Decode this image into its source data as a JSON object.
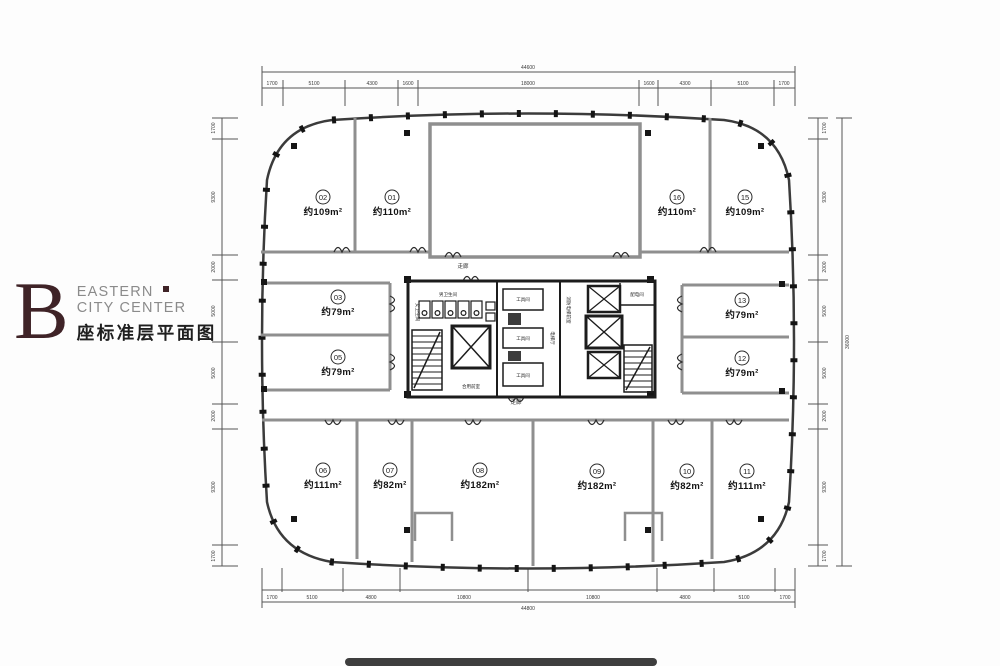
{
  "logo": {
    "letter": "B",
    "name_line1": "EASTERN",
    "name_line2": "CITY CENTER",
    "subtitle": "座标准层平面图",
    "brand_color": "#3f2327",
    "text_color": "#8b8b8b"
  },
  "plan": {
    "units": [
      {
        "num": "01",
        "area": "约110m²"
      },
      {
        "num": "02",
        "area": "约109m²"
      },
      {
        "num": "03",
        "area": "约79m²"
      },
      {
        "num": "05",
        "area": "约79m²"
      },
      {
        "num": "06",
        "area": "约111m²"
      },
      {
        "num": "07",
        "area": "约82m²"
      },
      {
        "num": "08",
        "area": "约182m²"
      },
      {
        "num": "09",
        "area": "约182m²"
      },
      {
        "num": "10",
        "area": "约82m²"
      },
      {
        "num": "11",
        "area": "约111m²"
      },
      {
        "num": "12",
        "area": "约79m²"
      },
      {
        "num": "13",
        "area": "约79m²"
      },
      {
        "num": "15",
        "area": "约109m²"
      },
      {
        "num": "16",
        "area": "约110m²"
      }
    ],
    "core": {
      "corridor_top": "走廊",
      "corridor_bottom": "走廊",
      "mens_wc": "男卫生间",
      "womens_wc": "女卫生间",
      "shared_lobby": "合用前室",
      "elevator_hall": "电梯厅",
      "fire_elevator_lobby": "消防电梯前室",
      "tool_room": "工具间",
      "power_room": "配电间"
    },
    "dims": {
      "top": {
        "total": "44600",
        "segments": [
          "1700",
          "5100",
          "4300",
          "1600",
          "18000",
          "1600",
          "4300",
          "5100",
          "1700"
        ]
      },
      "bottom": {
        "total": "44800",
        "segments": [
          "1700",
          "5100",
          "4800",
          "10800",
          "10800",
          "4800",
          "5100",
          "1700"
        ]
      },
      "left": {
        "segments": [
          "1700",
          "9300",
          "2000",
          "5000",
          "5000",
          "2000",
          "9300",
          "1700"
        ]
      },
      "right": {
        "total": "36000",
        "segments": [
          "1700",
          "9300",
          "2000",
          "5000",
          "5000",
          "2000",
          "9300",
          "1700"
        ]
      }
    }
  }
}
